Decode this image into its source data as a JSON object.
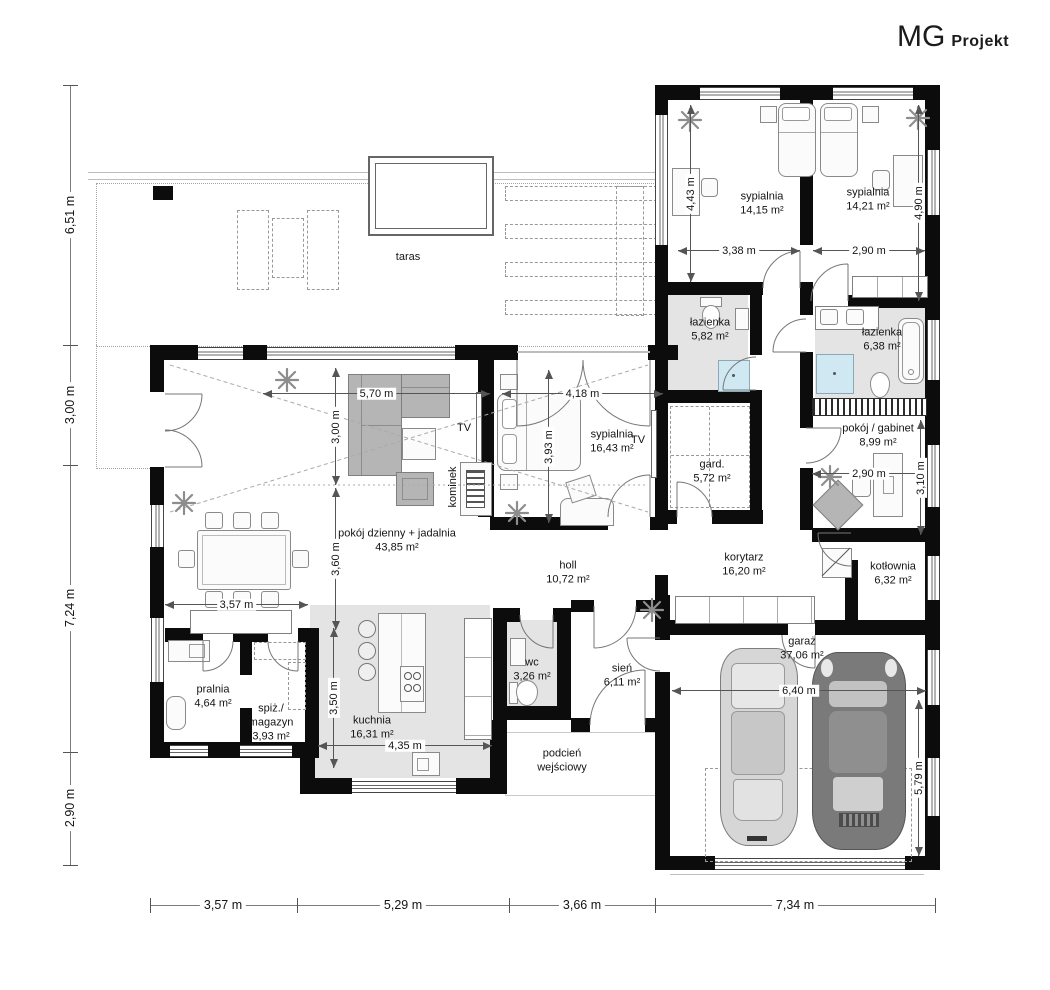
{
  "brand": {
    "mg": "MG",
    "projekt": "Projekt"
  },
  "rooms": {
    "taras": {
      "name": "taras"
    },
    "sypialnia1": {
      "name": "sypialnia",
      "area": "14,15 m²"
    },
    "sypialnia2": {
      "name": "sypialnia",
      "area": "14,21 m²"
    },
    "lazienka1": {
      "name": "łazienka",
      "area": "5,82 m²"
    },
    "lazienka2": {
      "name": "łazienka",
      "area": "6,38 m²"
    },
    "gabinet": {
      "name": "pokój / gabinet",
      "area": "8,99 m²"
    },
    "sypialnia3": {
      "name": "sypialnia",
      "area": "16,43 m²"
    },
    "gard": {
      "name": "gard.",
      "area": "5,72 m²"
    },
    "salon": {
      "name": "pokój dzienny + jadalnia",
      "area": "43,85 m²"
    },
    "holl": {
      "name": "holl",
      "area": "10,72 m²"
    },
    "korytarz": {
      "name": "korytarz",
      "area": "16,20 m²"
    },
    "kotlownia": {
      "name": "kotłownia",
      "area": "6,32 m²"
    },
    "kuchnia": {
      "name": "kuchnia",
      "area": "16,31 m²"
    },
    "wc": {
      "name": "wc",
      "area": "3,26 m²"
    },
    "sien": {
      "name": "sień",
      "area": "6,11 m²"
    },
    "garaz": {
      "name": "garaż",
      "area": "37,06 m²"
    },
    "pralnia": {
      "name": "pralnia",
      "area": "4,64 m²"
    },
    "spiz": {
      "name": "spiż./",
      "name2": "magazyn",
      "area": "3,93 m²"
    },
    "podcien": {
      "name": "podcień",
      "name2": "wejściowy"
    }
  },
  "labels": {
    "tv": "TV",
    "kominek": "kominek"
  },
  "dims": {
    "left": [
      "6,51 m",
      "3,00 m",
      "7,24 m",
      "2,90 m"
    ],
    "bottom": [
      "3,57 m",
      "5,29 m",
      "3,66 m",
      "7,34 m"
    ],
    "internal": {
      "bed1_h": "4,43 m",
      "bed1_w": "3,38 m",
      "bed2_w": "2,90 m",
      "bed2_h": "4,90 m",
      "master_w": "4,18 m",
      "master_h": "3,93 m",
      "salon_w": "5,70 m",
      "salon_h1": "3,00 m",
      "salon_h2": "3,60 m",
      "gab_w": "2,90 m",
      "gab_h": "3,10 m",
      "kuch_h": "3,50 m",
      "kuch_w": "4,35 m",
      "pral_w": "3,57 m",
      "gar_w": "6,40 m",
      "gar_h": "5,79 m"
    }
  },
  "colors": {
    "wall": "#0c0c0c",
    "floor_gray": "#e4e4e4",
    "shower_blue": "#cfe8f2",
    "car_light": "#d6d6d6",
    "car_dark": "#7a7a7a"
  }
}
